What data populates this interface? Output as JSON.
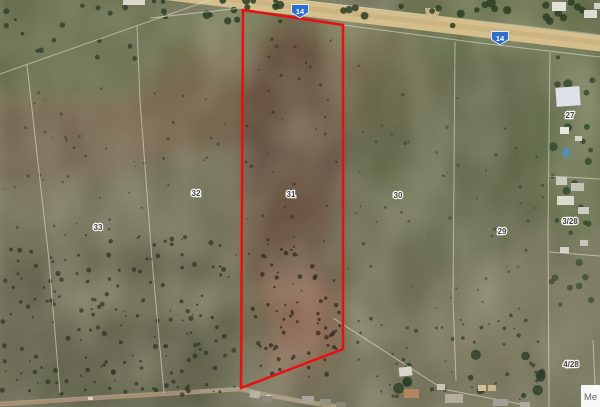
{
  "map": {
    "description": "satellite aerial view of farm parcels with highlighted erf outlined in red",
    "route_markers": [
      {
        "label": "14",
        "x": 300,
        "y": 11
      },
      {
        "label": "14",
        "x": 500,
        "y": 38
      }
    ],
    "route_marker_color": "#2e6fce",
    "parcel_labels": [
      {
        "text": "33",
        "x": 98,
        "y": 227
      },
      {
        "text": "32",
        "x": 196,
        "y": 193
      },
      {
        "text": "31",
        "x": 291,
        "y": 194
      },
      {
        "text": "30",
        "x": 398,
        "y": 195
      },
      {
        "text": "29",
        "x": 502,
        "y": 231
      },
      {
        "text": "27",
        "x": 570,
        "y": 115
      },
      {
        "text": "3/28",
        "x": 570,
        "y": 221
      },
      {
        "text": "4/28",
        "x": 571,
        "y": 364
      }
    ],
    "highlighted_parcel": {
      "label": "31",
      "outline_color": "#e81010",
      "points": "243,10 343,25 343,349 241,388"
    },
    "corner_label": {
      "text": "Me"
    }
  }
}
